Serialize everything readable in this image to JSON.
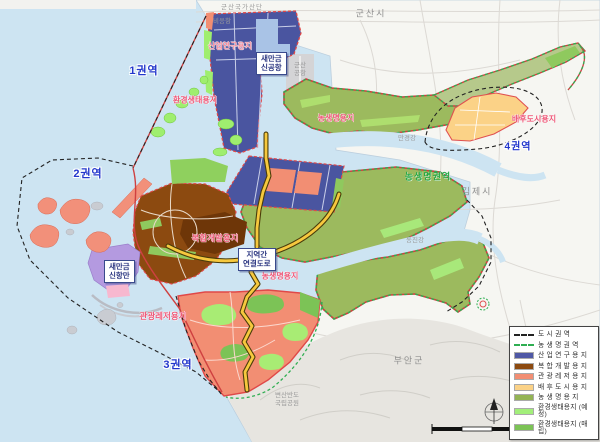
{
  "labels": {
    "gunsan_industrial": "군산국가산단",
    "gunsan_city": "군산시",
    "bieung_port": "비응항",
    "gunsan_airport_1": "군산",
    "gunsan_airport_2": "공항",
    "zone1": "1권역",
    "zone2": "2권역",
    "zone3": "3권역",
    "zone4": "4권역",
    "industry": "산업연구용지",
    "eco": "환경생태용지",
    "agri_north": "농생명용지",
    "agri_south": "농생명용지",
    "complex": "복합개발용지",
    "tourism": "관광레저용지",
    "hinterland": "배후도시용지",
    "agri_region": "농생명권역",
    "mangyeong_river": "만경강",
    "dongjin_river": "동진강",
    "gimje_city": "김제시",
    "buan_county": "부안군",
    "byeonsan_1": "변산반도",
    "byeonsan_2": "국립공원",
    "airport_box_1": "새만금",
    "airport_box_2": "신공항",
    "port_box_1": "새만금",
    "port_box_2": "신항만",
    "road_box_1": "지역간",
    "road_box_2": "연결도로"
  },
  "legend": {
    "items": [
      {
        "label": "도 시 권 역",
        "type": "line",
        "color": "#222222"
      },
      {
        "label": "농 생 명 권 역",
        "type": "line",
        "color": "#2fae52"
      },
      {
        "label": "산 업 연 구 용 지",
        "type": "fill",
        "color": "#4f58a5"
      },
      {
        "label": "복 합 개 발 용 지",
        "type": "fill",
        "color": "#8c4a10"
      },
      {
        "label": "관 광 레 저 용 지",
        "type": "fill",
        "color": "#f28e73"
      },
      {
        "label": "배 후 도 시 용 지",
        "type": "fill",
        "color": "#fbd287"
      },
      {
        "label": "농 생 명 용 지",
        "type": "fill",
        "color": "#94b455"
      },
      {
        "label": "환경생태용지 (예정)",
        "type": "fill",
        "color": "#a2ef7a"
      },
      {
        "label": "환경생태용지 (매립)",
        "type": "fill",
        "color": "#7cc356"
      }
    ]
  },
  "colors": {
    "water": "#cde4f2",
    "land": "#f6f6f2",
    "zone_label_blue": "#2236cc",
    "area_label_red": "#ee5878",
    "boundary_red": "#cf4040",
    "road_yellow": "#f6c83e"
  }
}
